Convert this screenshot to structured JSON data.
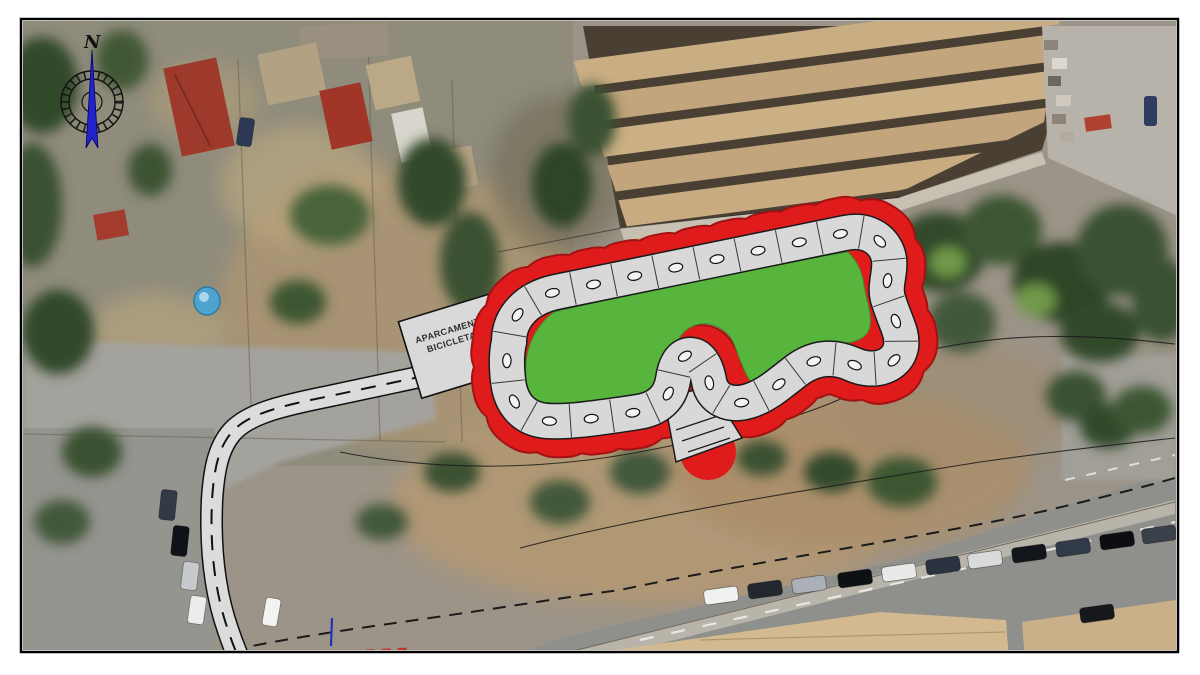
{
  "overlay": {
    "parking_label_line1": "APARCAMENTO",
    "parking_label_line2": "BICICLETAS",
    "compass_north_letter": "N"
  },
  "colors": {
    "track_red": "#e01b1b",
    "track_red_rim": "#a31212",
    "infield_green": "#57b43c",
    "track_surface": "#d8d8d8",
    "track_casing": "#1a1a1a",
    "path_surface": "#dcdcdc",
    "parking_surface": "#d9d9d9",
    "needle_blue": "#2323cc",
    "frame_border": "#000000"
  },
  "icons": {
    "compass": "compass-rose"
  }
}
